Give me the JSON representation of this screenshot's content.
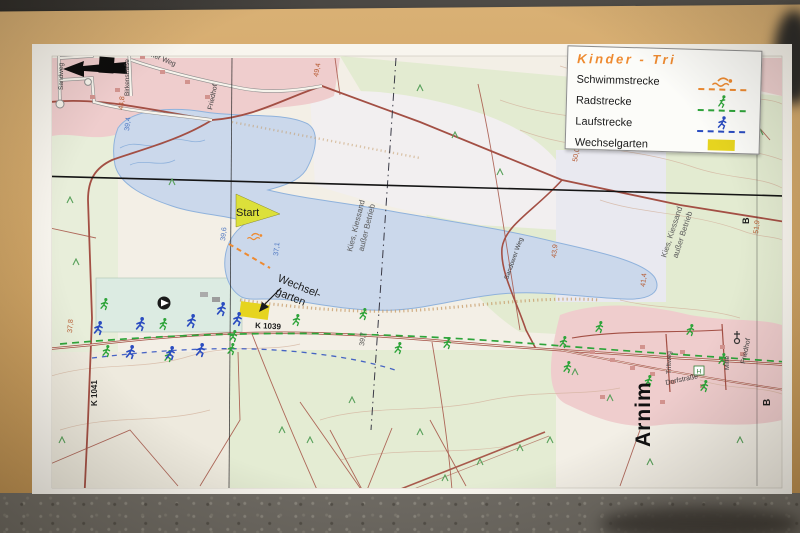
{
  "photo": {
    "background_top_color": "#45423e",
    "ground_color": "#6e6a63",
    "board_color": "#cda263",
    "paper_color": "#f8f5ee"
  },
  "legend": {
    "title": "Kinder - Tri",
    "title_color": "#ee8a30",
    "items": [
      {
        "label": "Schwimmstrecke",
        "color": "#ee8a30",
        "icon": "swimmer-icon",
        "style": "dashed-line"
      },
      {
        "label": "Radstrecke",
        "color": "#2ea43a",
        "icon": "cyclist-icon",
        "style": "dashed-line"
      },
      {
        "label": "Laufstrecke",
        "color": "#2a4cc0",
        "icon": "runner-icon",
        "style": "dashed-line"
      },
      {
        "label": "Wechselgarten",
        "color": "#e6d41f",
        "icon": "area-swatch",
        "style": "filled-rect"
      }
    ]
  },
  "map": {
    "labels": {
      "start": "Start",
      "wechsel_line1": "Wechsel-",
      "wechsel_line2": "garten",
      "k1039": "K 1039",
      "k1041": "K 1041",
      "arnim": "Arnim",
      "friedhof": "Friedhof",
      "dorfstrasse": "Dorfstraße",
      "triftweg": "Triftweg",
      "mitte": "Mitte",
      "sandower_weg": "Sandower Weg",
      "arnimer_weg": "Arnimer Weg",
      "birkenstrasse": "Birkenstraße",
      "sandweg": "Sandweg",
      "kies_line1": "Kies, Kiessand",
      "kies_line2": "außer Betrieb",
      "b_marker": "B",
      "bus_stop": "H"
    },
    "spot_heights": [
      {
        "text": "49,4",
        "x": 318,
        "y": 77,
        "rot": -80,
        "kind": "ground"
      },
      {
        "text": "45,3",
        "x": 568,
        "y": 44,
        "rot": -82,
        "kind": "ground"
      },
      {
        "text": "50,0",
        "x": 577,
        "y": 162,
        "rot": -80,
        "kind": "ground"
      },
      {
        "text": "44,8",
        "x": 123,
        "y": 110,
        "rot": -84,
        "kind": "ground"
      },
      {
        "text": "43,9",
        "x": 556,
        "y": 258,
        "rot": -84,
        "kind": "ground"
      },
      {
        "text": "41,4",
        "x": 645,
        "y": 287,
        "rot": -84,
        "kind": "ground"
      },
      {
        "text": "51,9",
        "x": 758,
        "y": 234,
        "rot": -84,
        "kind": "ground"
      },
      {
        "text": "37,8",
        "x": 72,
        "y": 333,
        "rot": -86,
        "kind": "ground"
      },
      {
        "text": "39,4",
        "x": 129,
        "y": 131,
        "rot": -84,
        "kind": "water"
      },
      {
        "text": "39,6",
        "x": 225,
        "y": 241,
        "rot": -84,
        "kind": "water"
      },
      {
        "text": "37,1",
        "x": 278,
        "y": 256,
        "rot": -84,
        "kind": "water"
      },
      {
        "text": "39,7",
        "x": 364,
        "y": 346,
        "rot": -84,
        "kind": "ground-dark"
      }
    ],
    "course_colors": {
      "swim": "#ee8a30",
      "bike": "#2ea43a",
      "run": "#2a4cc0"
    },
    "wechselgarten_color": "#e6d41f",
    "start_marker_color": "#dce03a",
    "runners_blue": [
      [
        98,
        328
      ],
      [
        140,
        324
      ],
      [
        191,
        321
      ],
      [
        221,
        309
      ],
      [
        237,
        319
      ],
      [
        130,
        352
      ],
      [
        170,
        353
      ],
      [
        200,
        350
      ]
    ],
    "figures_green": [
      [
        104,
        304
      ],
      [
        163,
        324
      ],
      [
        233,
        336
      ],
      [
        106,
        351
      ],
      [
        168,
        356
      ],
      [
        231,
        349
      ],
      [
        296,
        320
      ],
      [
        363,
        314
      ],
      [
        398,
        348
      ],
      [
        447,
        343
      ],
      [
        563,
        342
      ],
      [
        567,
        367
      ],
      [
        599,
        327
      ],
      [
        690,
        330
      ],
      [
        722,
        359
      ],
      [
        648,
        381
      ],
      [
        704,
        386
      ]
    ],
    "trees": [
      [
        420,
        88
      ],
      [
        455,
        135
      ],
      [
        500,
        172
      ],
      [
        605,
        72
      ],
      [
        686,
        47
      ],
      [
        730,
        92
      ],
      [
        760,
        132
      ],
      [
        575,
        372
      ],
      [
        610,
        398
      ],
      [
        420,
        432
      ],
      [
        352,
        400
      ],
      [
        282,
        430
      ],
      [
        480,
        462
      ],
      [
        650,
        462
      ],
      [
        550,
        440
      ],
      [
        70,
        200
      ],
      [
        76,
        262
      ],
      [
        62,
        440
      ],
      [
        172,
        182
      ],
      [
        310,
        440
      ],
      [
        445,
        478
      ],
      [
        520,
        448
      ],
      [
        740,
        440
      ]
    ]
  }
}
